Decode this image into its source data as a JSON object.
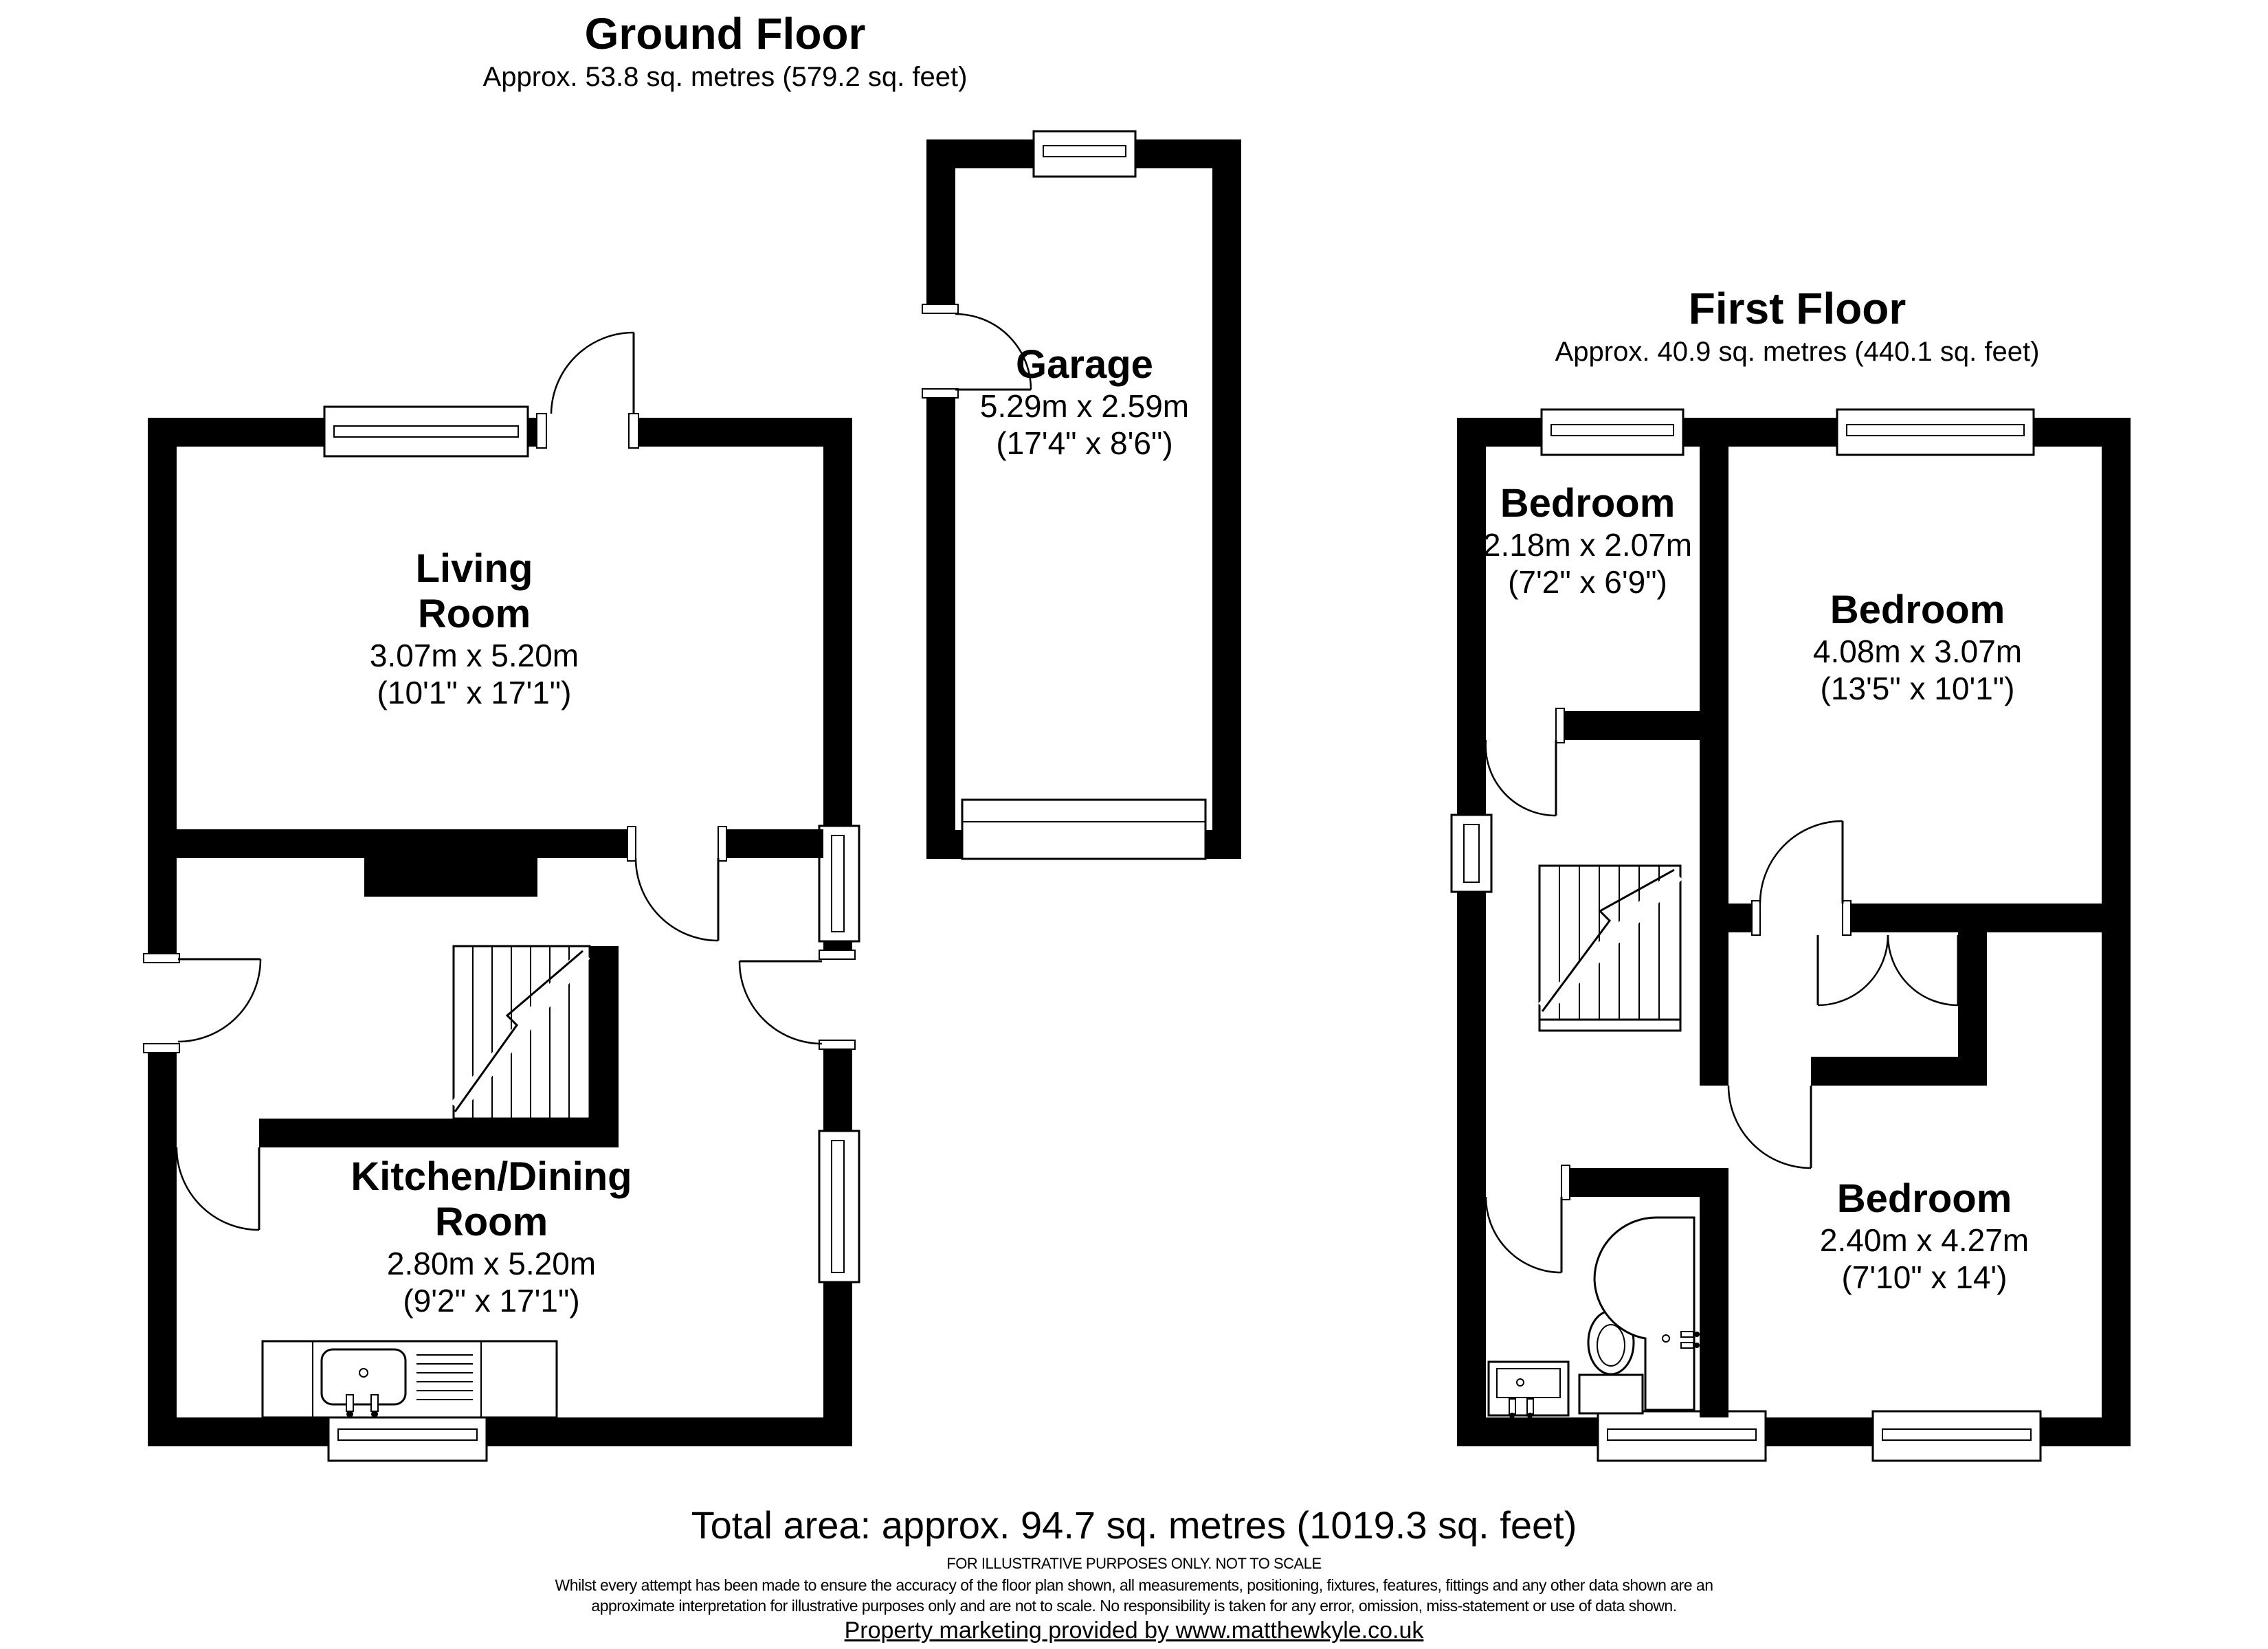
{
  "page": {
    "background": "#ffffff",
    "wall_color": "#000000",
    "line_color": "#000000"
  },
  "ground_floor": {
    "title": "Ground Floor",
    "subtitle": "Approx. 53.8 sq. metres (579.2 sq. feet)",
    "rooms": {
      "living": {
        "line1": "Living",
        "line2": "Room",
        "dims": "3.07m x 5.20m",
        "dims_imperial": "(10'1\" x 17'1\")"
      },
      "kitchen": {
        "line1": "Kitchen/Dining",
        "line2": "Room",
        "dims": "2.80m x 5.20m",
        "dims_imperial": "(9'2\" x 17'1\")"
      },
      "garage": {
        "name": "Garage",
        "dims": "5.29m x 2.59m",
        "dims_imperial": "(17'4\" x 8'6\")"
      }
    }
  },
  "first_floor": {
    "title": "First Floor",
    "subtitle": "Approx. 40.9 sq. metres (440.1 sq. feet)",
    "rooms": {
      "bedroom_small": {
        "name": "Bedroom",
        "dims": "2.18m x 2.07m",
        "dims_imperial": "(7'2\" x 6'9\")"
      },
      "bedroom_large": {
        "name": "Bedroom",
        "dims": "4.08m x 3.07m",
        "dims_imperial": "(13'5\" x 10'1\")"
      },
      "bedroom_back": {
        "name": "Bedroom",
        "dims": "2.40m x 4.27m",
        "dims_imperial": "(7'10\" x 14')"
      }
    }
  },
  "footer": {
    "total_area": "Total area: approx. 94.7 sq. metres (1019.3 sq. feet)",
    "illustrative_note": "FOR ILLUSTRATIVE PURPOSES ONLY. NOT TO SCALE",
    "disclaimer_line1": "Whilst every attempt has been made to ensure the accuracy of the floor plan shown, all measurements, positioning, fixtures, features, fittings and any other data shown are an",
    "disclaimer_line2": "approximate interpretation for illustrative purposes only and are not to scale. No responsibility is taken for any error, omission, miss-statement or use of data shown.",
    "marketing": "Property marketing provided by www.matthewkyle.co.uk"
  }
}
